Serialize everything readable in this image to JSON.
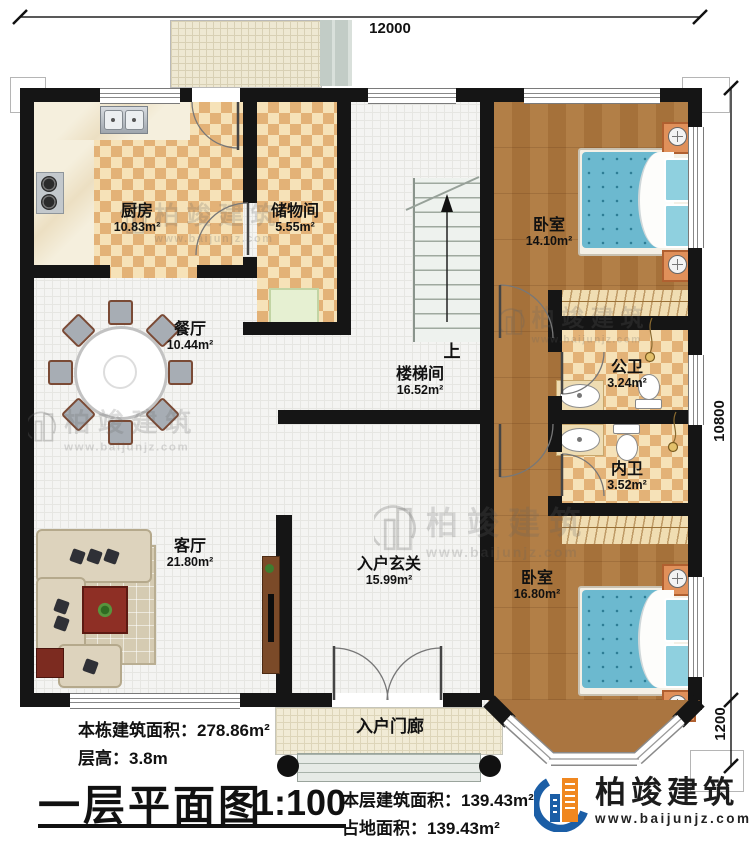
{
  "dimensions": {
    "top": "12000",
    "right_upper": "10800",
    "right_lower": "1200"
  },
  "rooms": {
    "kitchen": {
      "name": "厨房",
      "area": "10.83m²"
    },
    "storage": {
      "name": "储物间",
      "area": "5.55m²"
    },
    "dining": {
      "name": "餐厅",
      "area": "10.44m²"
    },
    "living": {
      "name": "客厅",
      "area": "21.80m²"
    },
    "stairwell": {
      "name": "楼梯间",
      "area": "16.52m²",
      "direction": "上"
    },
    "foyer": {
      "name": "入户玄关",
      "area": "15.99m²"
    },
    "porch": {
      "name": "入户门廊"
    },
    "bedroom_top": {
      "name": "卧室",
      "area": "14.10m²"
    },
    "bedroom_bottom": {
      "name": "卧室",
      "area": "16.80m²"
    },
    "bath_public": {
      "name": "公卫",
      "area": "3.24m²"
    },
    "bath_private": {
      "name": "内卫",
      "area": "3.52m²"
    }
  },
  "title_block": {
    "building_total_area": "本栋建筑面积：278.86m²",
    "floor_height": "层高：3.8m",
    "plan_title": "一层平面图",
    "scale": "1:100",
    "floor_area": "本层建筑面积：139.43m²",
    "footprint_area": "占地面积：139.43m²"
  },
  "brand": {
    "name": "柏竣建筑",
    "website": "www.baijunjz.com"
  },
  "watermark": {
    "text": "柏竣建筑",
    "url": "www.baijunjz.com"
  },
  "colors": {
    "wall": "#151515",
    "brand_blue": "#1b5ea6",
    "brand_orange": "#f0871f",
    "bed": "#6cb9cf",
    "wood_floor": "#aa7540",
    "tile_light": "#f6e2b8",
    "tile_dark": "#e3b277"
  }
}
